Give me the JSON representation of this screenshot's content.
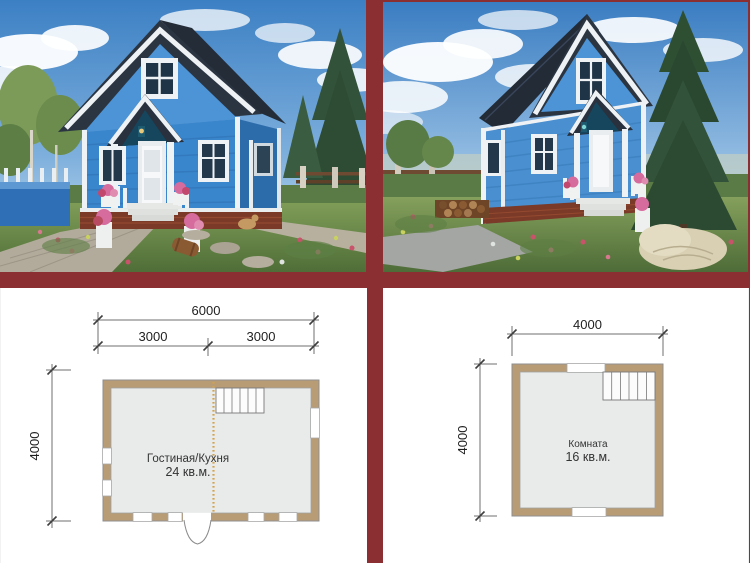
{
  "colors": {
    "frame_maroon": "#8b2f33",
    "plan_wall_tan": "#b89c75",
    "plan_floor_gray": "#e9ebea",
    "partition_dash_gold": "#d0a353",
    "house_blue": "#3a86cc",
    "roof_graphite": "#2b3542"
  },
  "plan_first": {
    "dim_total": "6000",
    "dim_left": "3000",
    "dim_right": "3000",
    "dim_depth": "4000",
    "room_name": "Гостиная/Кухня",
    "room_area": "24 кв.м."
  },
  "plan_second": {
    "dim_width": "4000",
    "dim_depth": "4000",
    "room_name": "Комната",
    "room_area": "16 кв.м."
  }
}
